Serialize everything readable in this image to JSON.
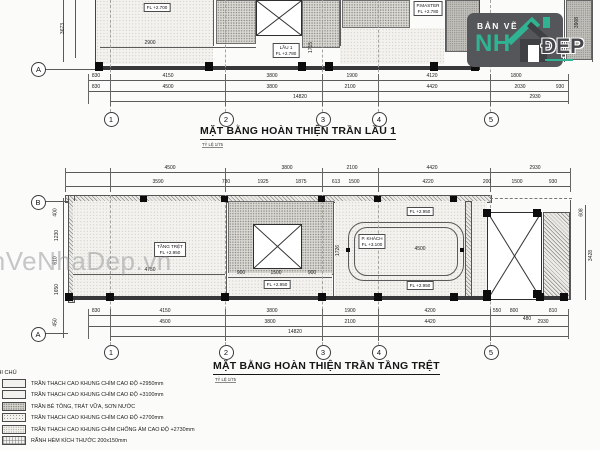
{
  "colors": {
    "accent_teal": "#2fb392",
    "wall_dark": "#38383a",
    "logo_bg": "#55565a"
  },
  "watermark": {
    "text": "BanVeNhaDep.vn"
  },
  "logo": {
    "top": "BẢN VẼ",
    "big": "NH",
    "right": "ĐẸP"
  },
  "lau1": {
    "title": "MẶT BẰNG HOÀN THIỆN TRẦN LẦU 1",
    "scale": "TỶ LỆ 1/75",
    "labels": {
      "left_fl": "FL +2.700",
      "center_name": "LẦU 1",
      "center_fl": "FL +2.780",
      "master_name": "P.MASTER",
      "master_fl": "FL +2.780",
      "dim_2900": "2900",
      "dim_1715": "1715"
    },
    "grid": {
      "a": "A",
      "cols": [
        "1",
        "2",
        "3",
        "4",
        "5"
      ]
    },
    "dims1": [
      "830",
      "4150",
      "3800",
      "1900",
      "4120",
      "1800"
    ],
    "dims2": [
      "830",
      "4500",
      "3800",
      "2100",
      "4420",
      "2030",
      "930"
    ],
    "dims3": [
      "14820",
      "2930"
    ],
    "vdims": [
      "3673",
      "3908"
    ]
  },
  "tret": {
    "title": "MẶT BẰNG HOÀN THIỆN TRẦN TẦNG TRỆT",
    "scale": "TỶ LỆ 1/75",
    "labels": {
      "tret_name": "TẦNG TRỆT",
      "tret_fl": "FL +2.950",
      "khach_name": "P. KHÁCH",
      "khach_fl": "FL +3.100",
      "fl_top": "FL +2.950",
      "fl_bottom": "FL +2.950",
      "fl_mid": "FL +2.950",
      "dim_4750": "4750",
      "dim_900a": "900",
      "dim_1500m": "1500",
      "dim_900b": "900",
      "dim_4500i": "4500",
      "dim_1726": "1726"
    },
    "grid": {
      "a": "A",
      "b": "B",
      "cols": [
        "1",
        "2",
        "3",
        "4",
        "5"
      ]
    },
    "dimsT1": [
      "4500",
      "3800",
      "2100",
      "4420",
      "2930"
    ],
    "dimsT2": [
      "3590",
      "730",
      "1925",
      "1875",
      "613",
      "1500",
      "4220",
      "200",
      "1500",
      "930"
    ],
    "dimsB1": [
      "830",
      "4150",
      "3800",
      "1900",
      "4200",
      "550",
      "800",
      "810"
    ],
    "dimsB2": [
      "4500",
      "3800",
      "2100",
      "4420",
      "480",
      "2930"
    ],
    "dimsB3": [
      "14820"
    ],
    "vdimsL": [
      "400",
      "1230",
      "610",
      "1650",
      "450"
    ],
    "vdimsR": [
      "608",
      "3428"
    ]
  },
  "legend": {
    "header": "GHI CHÚ",
    "rows": [
      {
        "label": "TRẦN THẠCH CAO KHUNG CHÌM CAO ĐỘ +2950mm"
      },
      {
        "label": "TRẦN THẠCH CAO KHUNG CHÌM CAO ĐỘ +3100mm"
      },
      {
        "label": "TRẦN BÊ TÔNG, TRÁT VỮA, SƠN NƯỚC"
      },
      {
        "label": "TRẦN THẠCH CAO KHUNG CHÌM CAO ĐỘ +2700mm"
      },
      {
        "label": "TRẦN THẠCH CAO KHUNG CHÌM CHỐNG ẨM CAO ĐỘ +2730mm"
      },
      {
        "label": "RÃNH HÈM KÍCH THƯỚC 200x150mm"
      }
    ]
  }
}
